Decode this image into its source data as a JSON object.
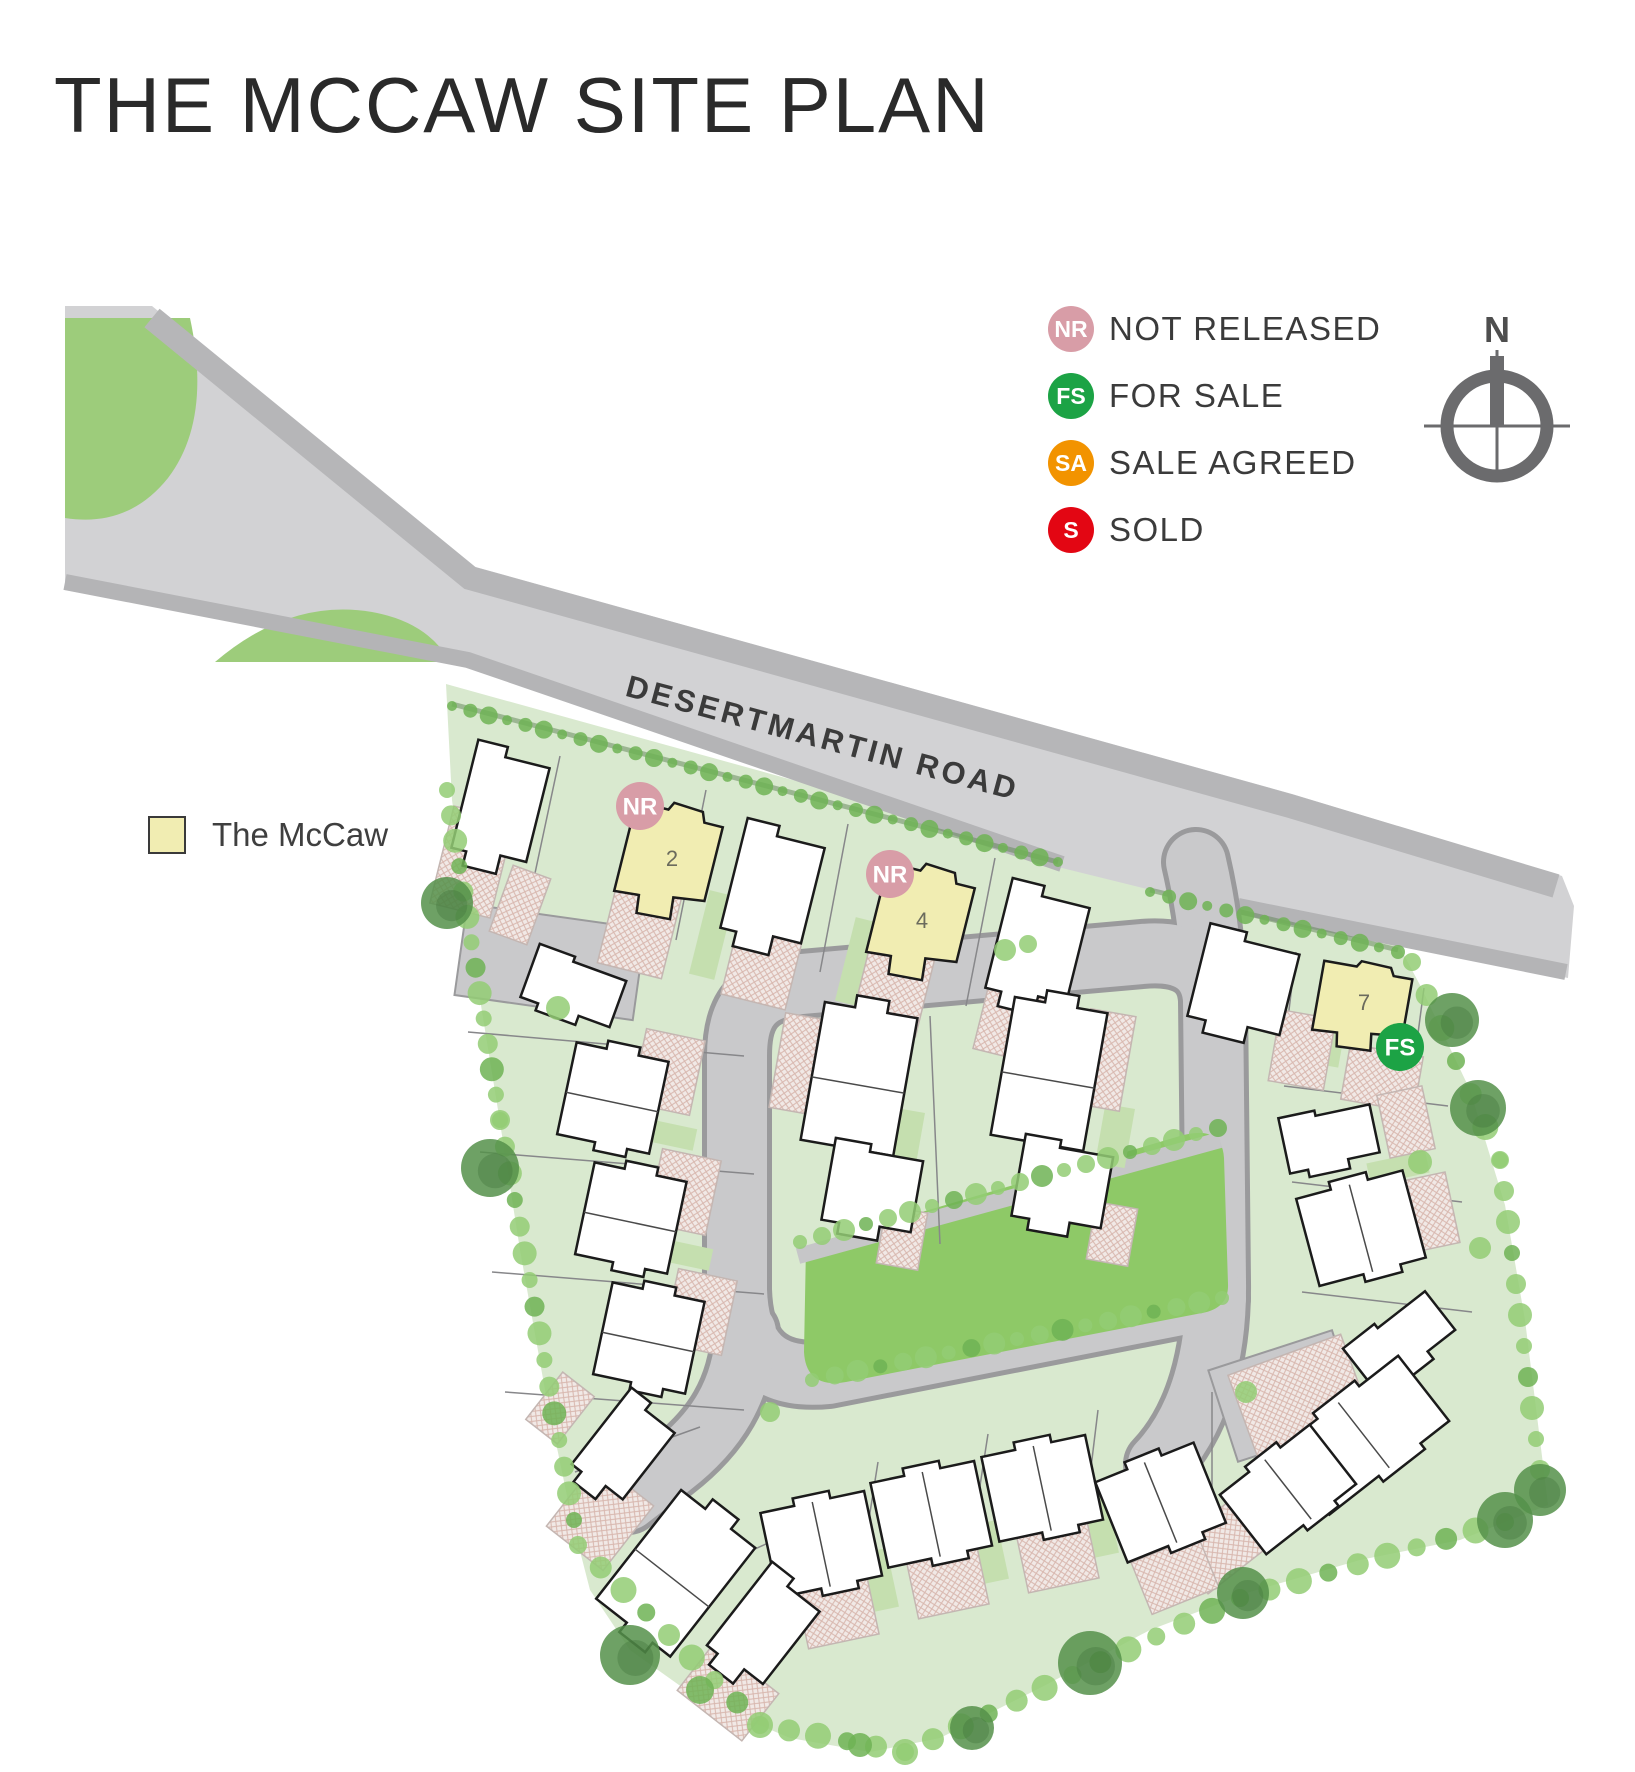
{
  "page": {
    "title": "THE MCCAW SITE PLAN"
  },
  "legend": {
    "items": [
      {
        "code": "NR",
        "label": "NOT RELEASED",
        "color": "#d89da7"
      },
      {
        "code": "FS",
        "label": "FOR SALE",
        "color": "#1ca345"
      },
      {
        "code": "SA",
        "label": "SALE AGREED",
        "color": "#f29300"
      },
      {
        "code": "S",
        "label": "SOLD",
        "color": "#e30613"
      }
    ]
  },
  "house_type_key": {
    "label": "The McCaw",
    "swatch_color": "#f1edb2"
  },
  "compass": {
    "label": "N"
  },
  "road": {
    "name": "DESERTMARTIN ROAD"
  },
  "plots": [
    {
      "number": "2",
      "status": "NR",
      "status_label": "NOT RELEASED"
    },
    {
      "number": "4",
      "status": "NR",
      "status_label": "NOT RELEASED"
    },
    {
      "number": "7",
      "status": "FS",
      "status_label": "FOR SALE"
    }
  ],
  "map_colors": {
    "site_green": "#d9e9cf",
    "open_space_green": "#8ec967",
    "main_road": "#d2d2d4",
    "internal_road": "#c9c9cb",
    "highlight_house": "#f1edb2",
    "tree_light": "#93cc74",
    "tree_dark": "#55914a"
  }
}
